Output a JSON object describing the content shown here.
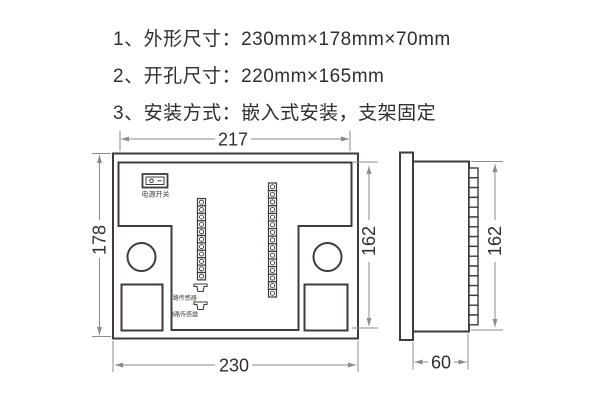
{
  "specs": {
    "line1": "1、外形尺寸：230mm×178mm×70mm",
    "line2": "2、开孔尺寸：220mm×165mm",
    "line3": "3、安装方式：嵌入式安装，支架固定"
  },
  "front_view": {
    "dim_width_top": "217",
    "dim_height_left": "178",
    "dim_height_right": "162",
    "dim_width_bottom": "230",
    "power_switch": {
      "label": "电源开关",
      "icons": [
        "switch-off-circle-icon",
        "switch-on-dash-icon"
      ]
    },
    "sensors": {
      "channel1_label": "Ⅰ路传感器",
      "channel2_label": "Ⅱ路传感器"
    },
    "left_terminal_count": 11,
    "right_terminal_count": 15
  },
  "side_view": {
    "dim_height_right": "162",
    "dim_depth_bottom": "60",
    "terminal_count": 16
  },
  "colors": {
    "line": "#403b39",
    "dimension": "#8e8b8a",
    "text": "#322e2d",
    "background": "#ffffff"
  }
}
